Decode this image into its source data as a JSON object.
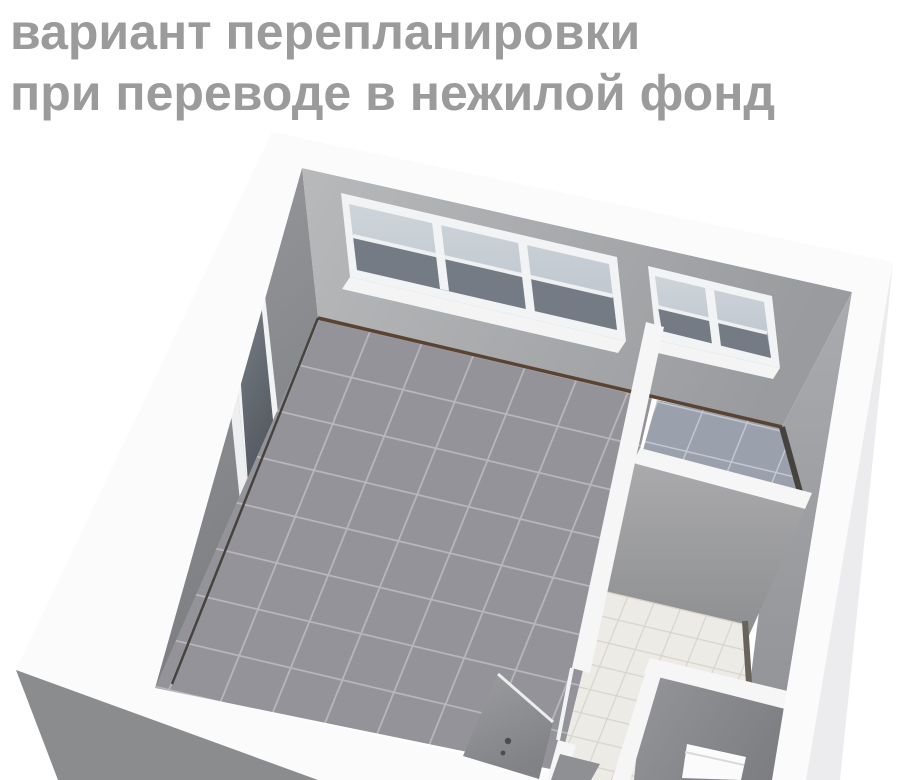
{
  "page": {
    "background": "#ffffff"
  },
  "title": {
    "line1": "вариант перепланировки",
    "line2": "при переводе в нежилой фонд"
  },
  "colors": {
    "title_text": "#9b9b9b",
    "wall_top_band": "#fbfbfc",
    "partition_top": "#f6f6f7",
    "wall_outer_right": "#ececee",
    "wall_outer_front": "#8a8c8e",
    "floor_main": "#95939a",
    "grout_main": "#b9b7bc",
    "floor_corr": "#9aa1ac",
    "grout_corr": "#c2c8d2",
    "floor_bath": "#edebe5",
    "grout_bath": "#d7d4ca",
    "baseboard_brown": "#5a4330",
    "baseboard_dark": "#46423d",
    "window_frame": "#f2f3f4",
    "glass_light": "#c7ced5",
    "glass_dark": "#747b84",
    "door_handle": "#4a4c4e",
    "toilet_white": "#fbfbfb",
    "trim_dark": "#6a635c"
  }
}
